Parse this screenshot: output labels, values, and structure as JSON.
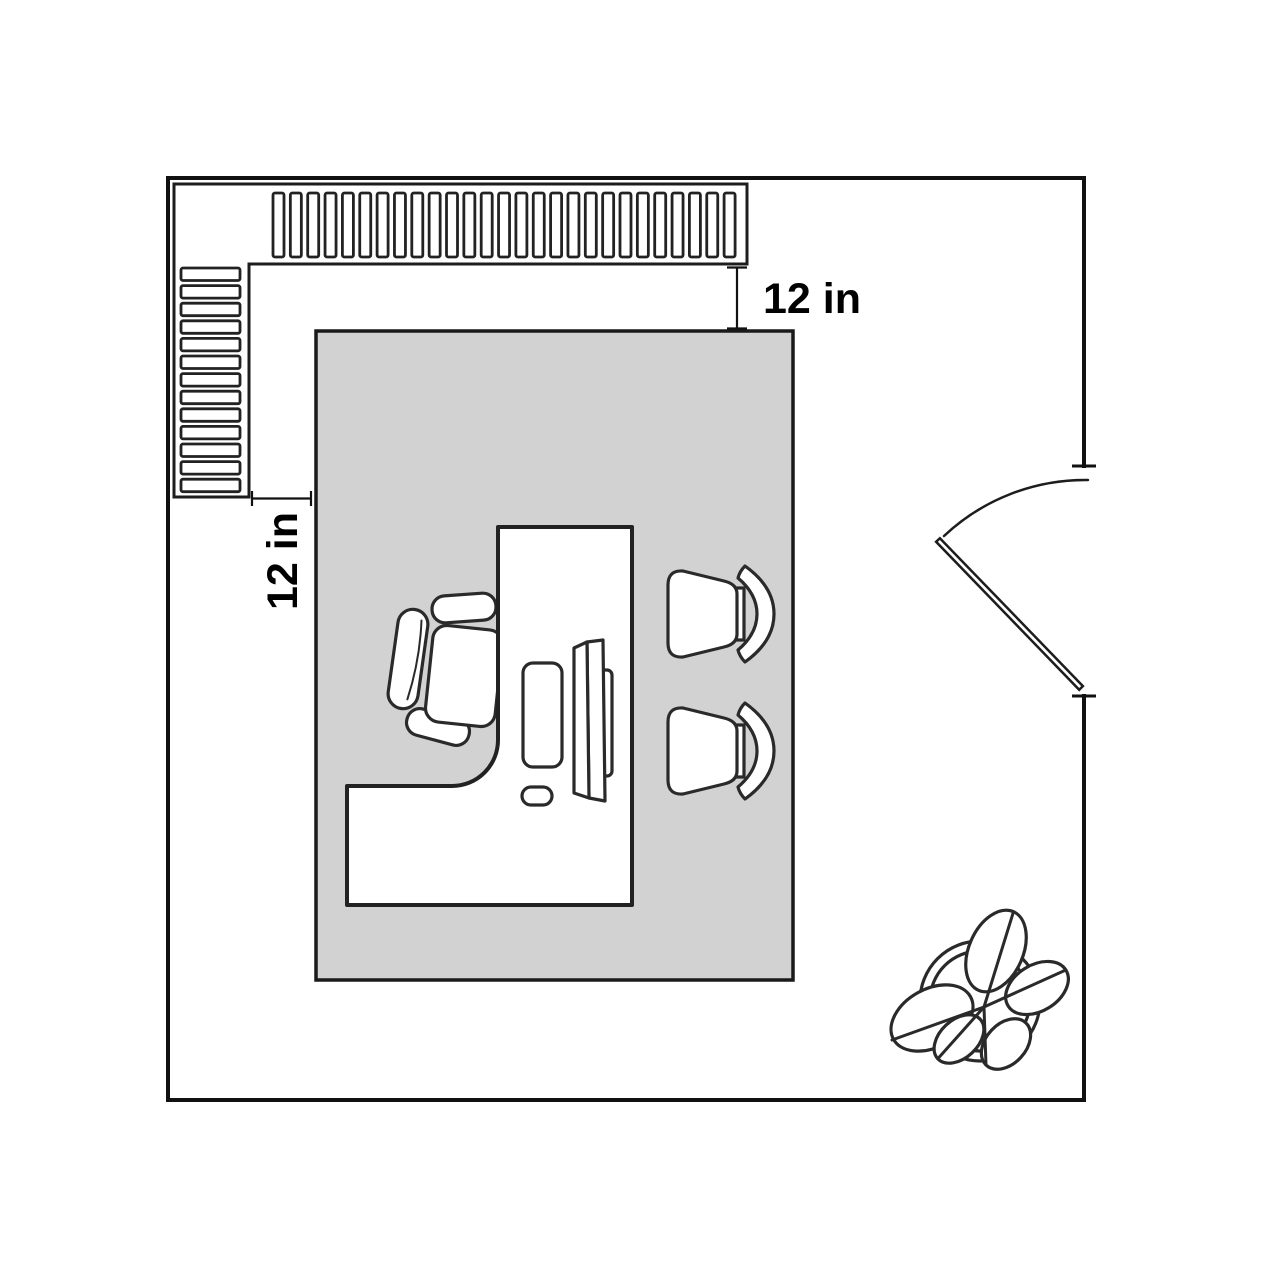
{
  "diagram": {
    "type": "floor-plan",
    "room": "office with L-shaped desk, wall shelving, two guest chairs, door and potted plant",
    "colors": {
      "background": "#ffffff",
      "wall": "#111111",
      "outline": "#2a2a2a",
      "rug_fill": "#d2d2d2",
      "label": "#000000"
    },
    "dimensions": {
      "top_clearance_label": "12 in",
      "left_clearance_label": "12 in"
    },
    "shelves": {
      "top_slats": {
        "count": 27,
        "x0": 273,
        "pitch": 17.35,
        "y": 193,
        "w": 11,
        "h": 64
      },
      "left_slats": {
        "count": 13,
        "y0": 268,
        "pitch": 17.6,
        "x": 181,
        "w": 59,
        "h": 12.5
      }
    },
    "furniture": {
      "guest_chair_count": 2,
      "plant_leaf_count": 5,
      "items": [
        "shelf-unit",
        "rug",
        "l-shaped-desk",
        "office-chair",
        "keyboard",
        "monitor",
        "mouse",
        "guest-chair",
        "guest-chair",
        "door",
        "potted-plant"
      ]
    }
  }
}
